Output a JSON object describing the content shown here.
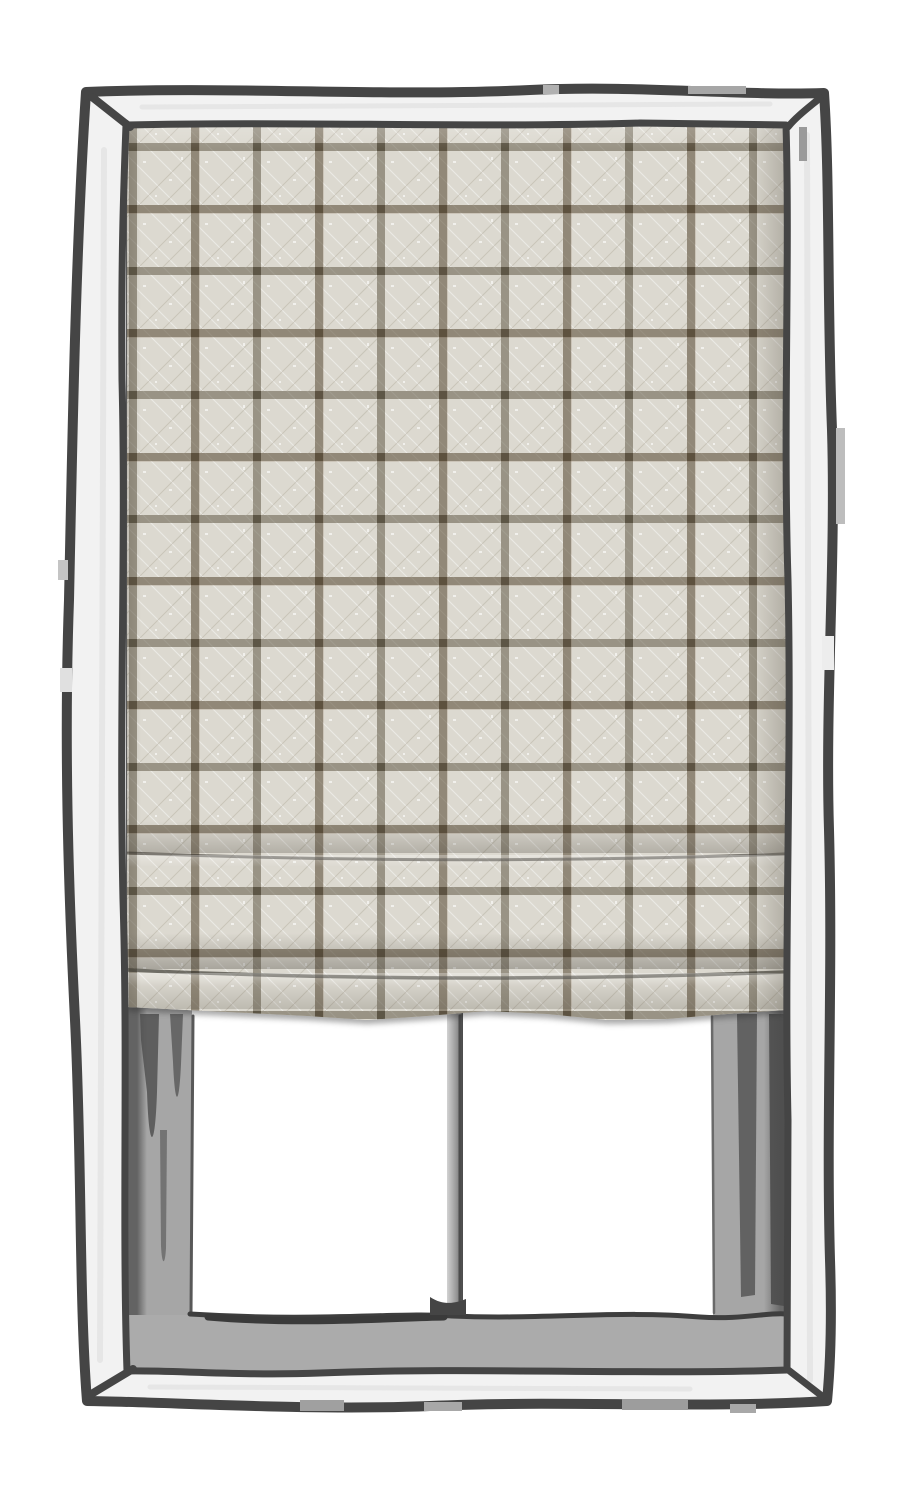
{
  "meta": {
    "type": "product-illustration",
    "subject": "Roman shade with beige windowpane-check (tattersall) linen fabric, shown lowered inside a hand-sketched white window frame with two panes below"
  },
  "palette": {
    "background": "#ffffff",
    "ink": "#454545",
    "ink_soft": "#5a5a5a",
    "frame_face": "#f2f2f2",
    "face_shading": "#e6e6e6",
    "reveal": "#a6a6a6",
    "reveal_streak": "#515151",
    "sill": "#ababab",
    "mullion_light": "#d2d2d2",
    "mullion_dark": "#4e4e4e",
    "pane": "#ffffff",
    "fabric_base": "#dcd9d0",
    "stripe": "rgba(86,78,58,0.50)",
    "stripe_cross": "rgba(55,48,32,0.40)",
    "warm_stripe": "rgba(96,70,45,0.14)"
  },
  "pattern": {
    "style": "windowpane check",
    "texture": "linen with herringbone stripe weave",
    "cell_px": 62,
    "stripe_px": 8,
    "offset_x_px": 2,
    "offset_y_px": 20,
    "fold_count": 2
  },
  "parts": {
    "frame": "window frame",
    "shade": "roman shade",
    "pane_left": "left window pane",
    "pane_right": "right window pane",
    "mullion": "center mullion",
    "sill": "window sill",
    "reveal_left": "left jamb reveal",
    "reveal_right": "right jamb reveal"
  }
}
